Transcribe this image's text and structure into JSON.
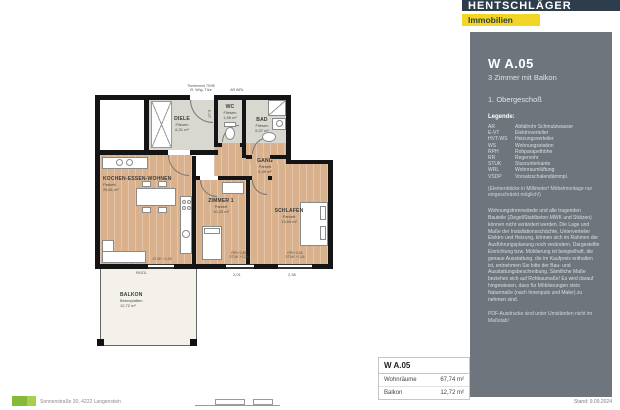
{
  "header": {
    "brand": "HENTSCHLÄGER",
    "brand_sub": "Immobilien"
  },
  "sidebar": {
    "unit": "W A.05",
    "subtitle": "3 Zimmer mit Balkon",
    "floor": "1. Obergeschoß",
    "legend_title": "Legende:",
    "legend": [
      {
        "abbr": "AR",
        "label": "Abfallrohr Schmutzwasser"
      },
      {
        "abbr": "E-VT",
        "label": "Elektroverteiler"
      },
      {
        "abbr": "HVT-WS",
        "label": "Heizungsverteiler"
      },
      {
        "abbr": "WS",
        "label": "Wohnungsstation"
      },
      {
        "abbr": "RPH",
        "label": "Rohparapethöhe"
      },
      {
        "abbr": "RR",
        "label": "Regenrohr"
      },
      {
        "abbr": "STUK",
        "label": "Sturzunterkante"
      },
      {
        "abbr": "WRL",
        "label": "Wohnraumlüftung"
      },
      {
        "abbr": "VSDP",
        "label": "Vorsatzschalendämmpl."
      }
    ],
    "note_element": "(Elementdicke in Millimeter! Möbelmontage nur eingeschränkt möglich!)",
    "paragraph": "Wohnungstrennwände und alle tragenden Bauteile (Ziegel/Stahlbeton-MWK und Stützen) können nicht verändert werden. Die Lage und Maße der Installationsschächte, Unterverteiler Elektro und Heizung, können sich im Rahmen der Ausführungsplanung noch verändern. Dargestellte Einrichtung bzw. Möblierung ist beispielhaft, die genaue Ausstattung, die im Kaufpreis enthalten ist, entnehmen Sie bitte der Bau- und Ausstattungsbeschreibung. Sämtliche Maße beziehen sich auf Rohbaumaße! Es wird darauf hingewiesen, dass für Möblierungen stets Naturmaße (nach Innenputz und Maler) zu nehmen sind.",
    "note_pdf": "PDF-Ausdrucke sind unter Umständen nicht im Maßstab!"
  },
  "floorplan": {
    "rooms": [
      {
        "name": "DIELE",
        "floor": "Fliesen",
        "area": "6,31 m²"
      },
      {
        "name": "WC",
        "floor": "Fliesen",
        "area": "1,96 m²"
      },
      {
        "name": "BAD",
        "floor": "Fliesen",
        "area": "5,37 m²"
      },
      {
        "name": "GANG",
        "floor": "Parkett",
        "area": "4,49 m²"
      },
      {
        "name": "KOCHEN-ESSEN-WOHNEN",
        "floor": "Parkett",
        "area": "25,61 m²"
      },
      {
        "name": "ZIMMER 1",
        "floor": "Parkett",
        "area": "10,20 m²"
      },
      {
        "name": "SCHLAFEN",
        "floor": "Parkett",
        "area": "13,50 m²"
      },
      {
        "name": "BALKON",
        "floor": "Betonplatten",
        "area": "12,72 m²"
      }
    ],
    "annotations": {
      "entrance_line1": "Türelement 70/95",
      "entrance_line2": "El. Whg.-Türe",
      "shaft_ar_wrl": "AR  WRL",
      "shaft_evt": "E-VT",
      "rigol": "RIGOL",
      "win_zimmer1_rph": "RPH 0,85",
      "win_zimmer1_stuk": "STUK +2,26",
      "win_schlafen_rph": "RPH 0,85",
      "win_schlafen_stuk": "STUK +2,26",
      "door_balkon_stuk": "STUK +2,26",
      "dim_zimmer1": "2,01",
      "dim_schlafen": "2,38"
    }
  },
  "summary_table": {
    "title": "W A.05",
    "rows": [
      {
        "label": "Wohnräume",
        "value": "67,74 m²"
      },
      {
        "label": "Balkon",
        "value": "12,72 m²"
      }
    ]
  },
  "footer": {
    "address": "Sonnenstraße 30, 4222 Langenstein",
    "stand": "Stand: 9.09.2024"
  },
  "colors": {
    "brand_navy": "#2e3d4c",
    "accent_yellow": "#f3d524",
    "sidebar_gray": "#6e757c",
    "parquet": "#d9b28d",
    "tile": "#d8d8d1"
  }
}
